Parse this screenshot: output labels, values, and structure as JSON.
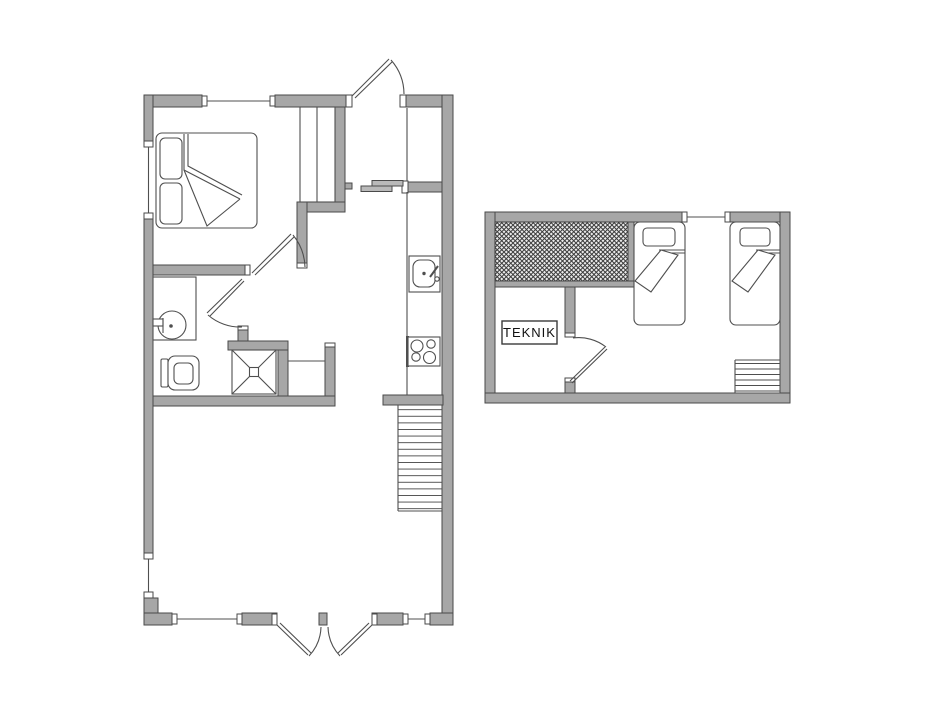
{
  "canvas": {
    "width": 950,
    "height": 713,
    "background": "#ffffff"
  },
  "colors": {
    "wall-fill": "#a7a7a7",
    "wall-stroke": "#4a4a4a",
    "line": "#4f4f4f",
    "slider-fill": "#b9b9b9",
    "hatch-bg": "#ececec",
    "hatch-line": "#3c3c3c"
  },
  "plans": {
    "ground_floor": {
      "name": "ground-floor-plan",
      "fixtures": [
        "double-bed",
        "wardrobe",
        "entry-door",
        "sliding-door",
        "washbasin",
        "toilet",
        "shower",
        "kitchen-sink",
        "stove",
        "staircase",
        "french-doors",
        "windows"
      ]
    },
    "upper_floor": {
      "name": "upper-floor-plan",
      "teknik_label": "TEKNIK",
      "fixtures": [
        "hatched-void",
        "technical-room",
        "single-bed-left",
        "single-bed-right",
        "staircase",
        "interior-door",
        "window"
      ]
    }
  }
}
